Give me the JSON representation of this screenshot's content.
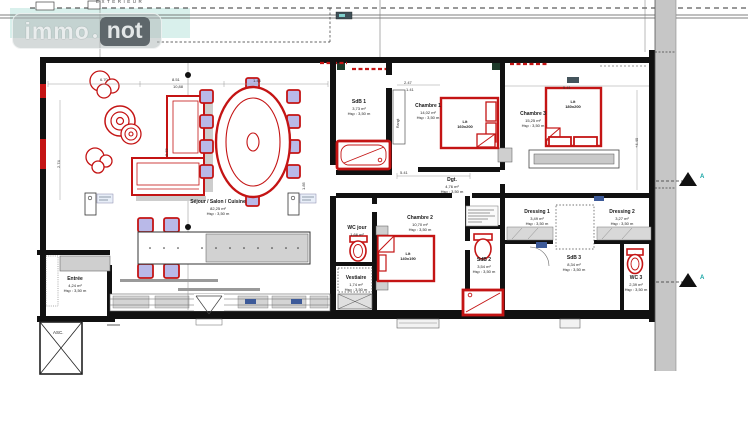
{
  "watermark": {
    "left": "immo",
    "dot": ".",
    "right": "not"
  },
  "site": {
    "exterior_label": "EXTERIEUR"
  },
  "building": {
    "elevator_label": "ASC.",
    "closet_label": "Rangt"
  },
  "rooms": [
    {
      "name": "Séjour / Salon / Cuisine",
      "area": "82,25 m²",
      "hsp": "Hsp : 3,50 m"
    },
    {
      "name": "SdB 1",
      "area": "3,73 m²",
      "hsp": "Hsp : 3,50 m"
    },
    {
      "name": "Chambre 1",
      "area": "14,02 m²",
      "hsp": "Hsp : 3,50 m"
    },
    {
      "name": "Lit",
      "area": "160x200",
      "hsp": ""
    },
    {
      "name": "Dgt.",
      "area": "4,76 m²",
      "hsp": "Hsp : 3,50 m"
    },
    {
      "name": "Chambre 3",
      "area": "15,25 m²",
      "hsp": "Hsp : 3,50 m"
    },
    {
      "name": "Lit",
      "area": "180x200",
      "hsp": ""
    },
    {
      "name": "WC jour",
      "area": "1,66 m²",
      "hsp": ""
    },
    {
      "name": "Chambre 2",
      "area": "10,70 m²",
      "hsp": "Hsp : 3,50 m"
    },
    {
      "name": "Lit",
      "area": "140x190",
      "hsp": ""
    },
    {
      "name": "Vestiaire",
      "area": "1,74 m²",
      "hsp": "Hsp : 3,50 m"
    },
    {
      "name": "SdB 2",
      "area": "3,54 m²",
      "hsp": "Hsp : 3,50 m"
    },
    {
      "name": "Dressing 1",
      "area": "3,49 m²",
      "hsp": "Hsp : 3,50 m"
    },
    {
      "name": "Dressing 2",
      "area": "3,27 m²",
      "hsp": "Hsp : 3,50 m"
    },
    {
      "name": "SdB 3",
      "area": "8,34 m²",
      "hsp": "Hsp : 3,50 m"
    },
    {
      "name": "WC 3",
      "area": "2,39 m²",
      "hsp": "Hsp : 3,50 m"
    },
    {
      "name": "Entrée",
      "area": "4,24 m²",
      "hsp": "Hsp : 3,50 m"
    }
  ],
  "dimensions": [
    {
      "value": "6.70"
    },
    {
      "value": "8.51"
    },
    {
      "value": "10,88"
    },
    {
      "value": "1.44"
    },
    {
      "value": "2.47"
    },
    {
      "value": "1.41"
    },
    {
      "value": "5.41"
    },
    {
      "value": "5.41"
    },
    {
      "value": "2.74"
    },
    {
      "value": "2.72"
    },
    {
      "value": "1.85"
    },
    {
      "value": "+4.40"
    }
  ],
  "section_markers": [
    {
      "letter": "A"
    },
    {
      "letter": "A"
    }
  ],
  "colors": {
    "accent_red": "#c41414",
    "chair_fill": "#b9b9e8",
    "teal_highlight": "#d9f0ec",
    "wall_black": "#111111",
    "gray_fill": "#c6c6c6",
    "chip_blue": "#3d5a99",
    "marker_teal": "#12a3a3"
  }
}
